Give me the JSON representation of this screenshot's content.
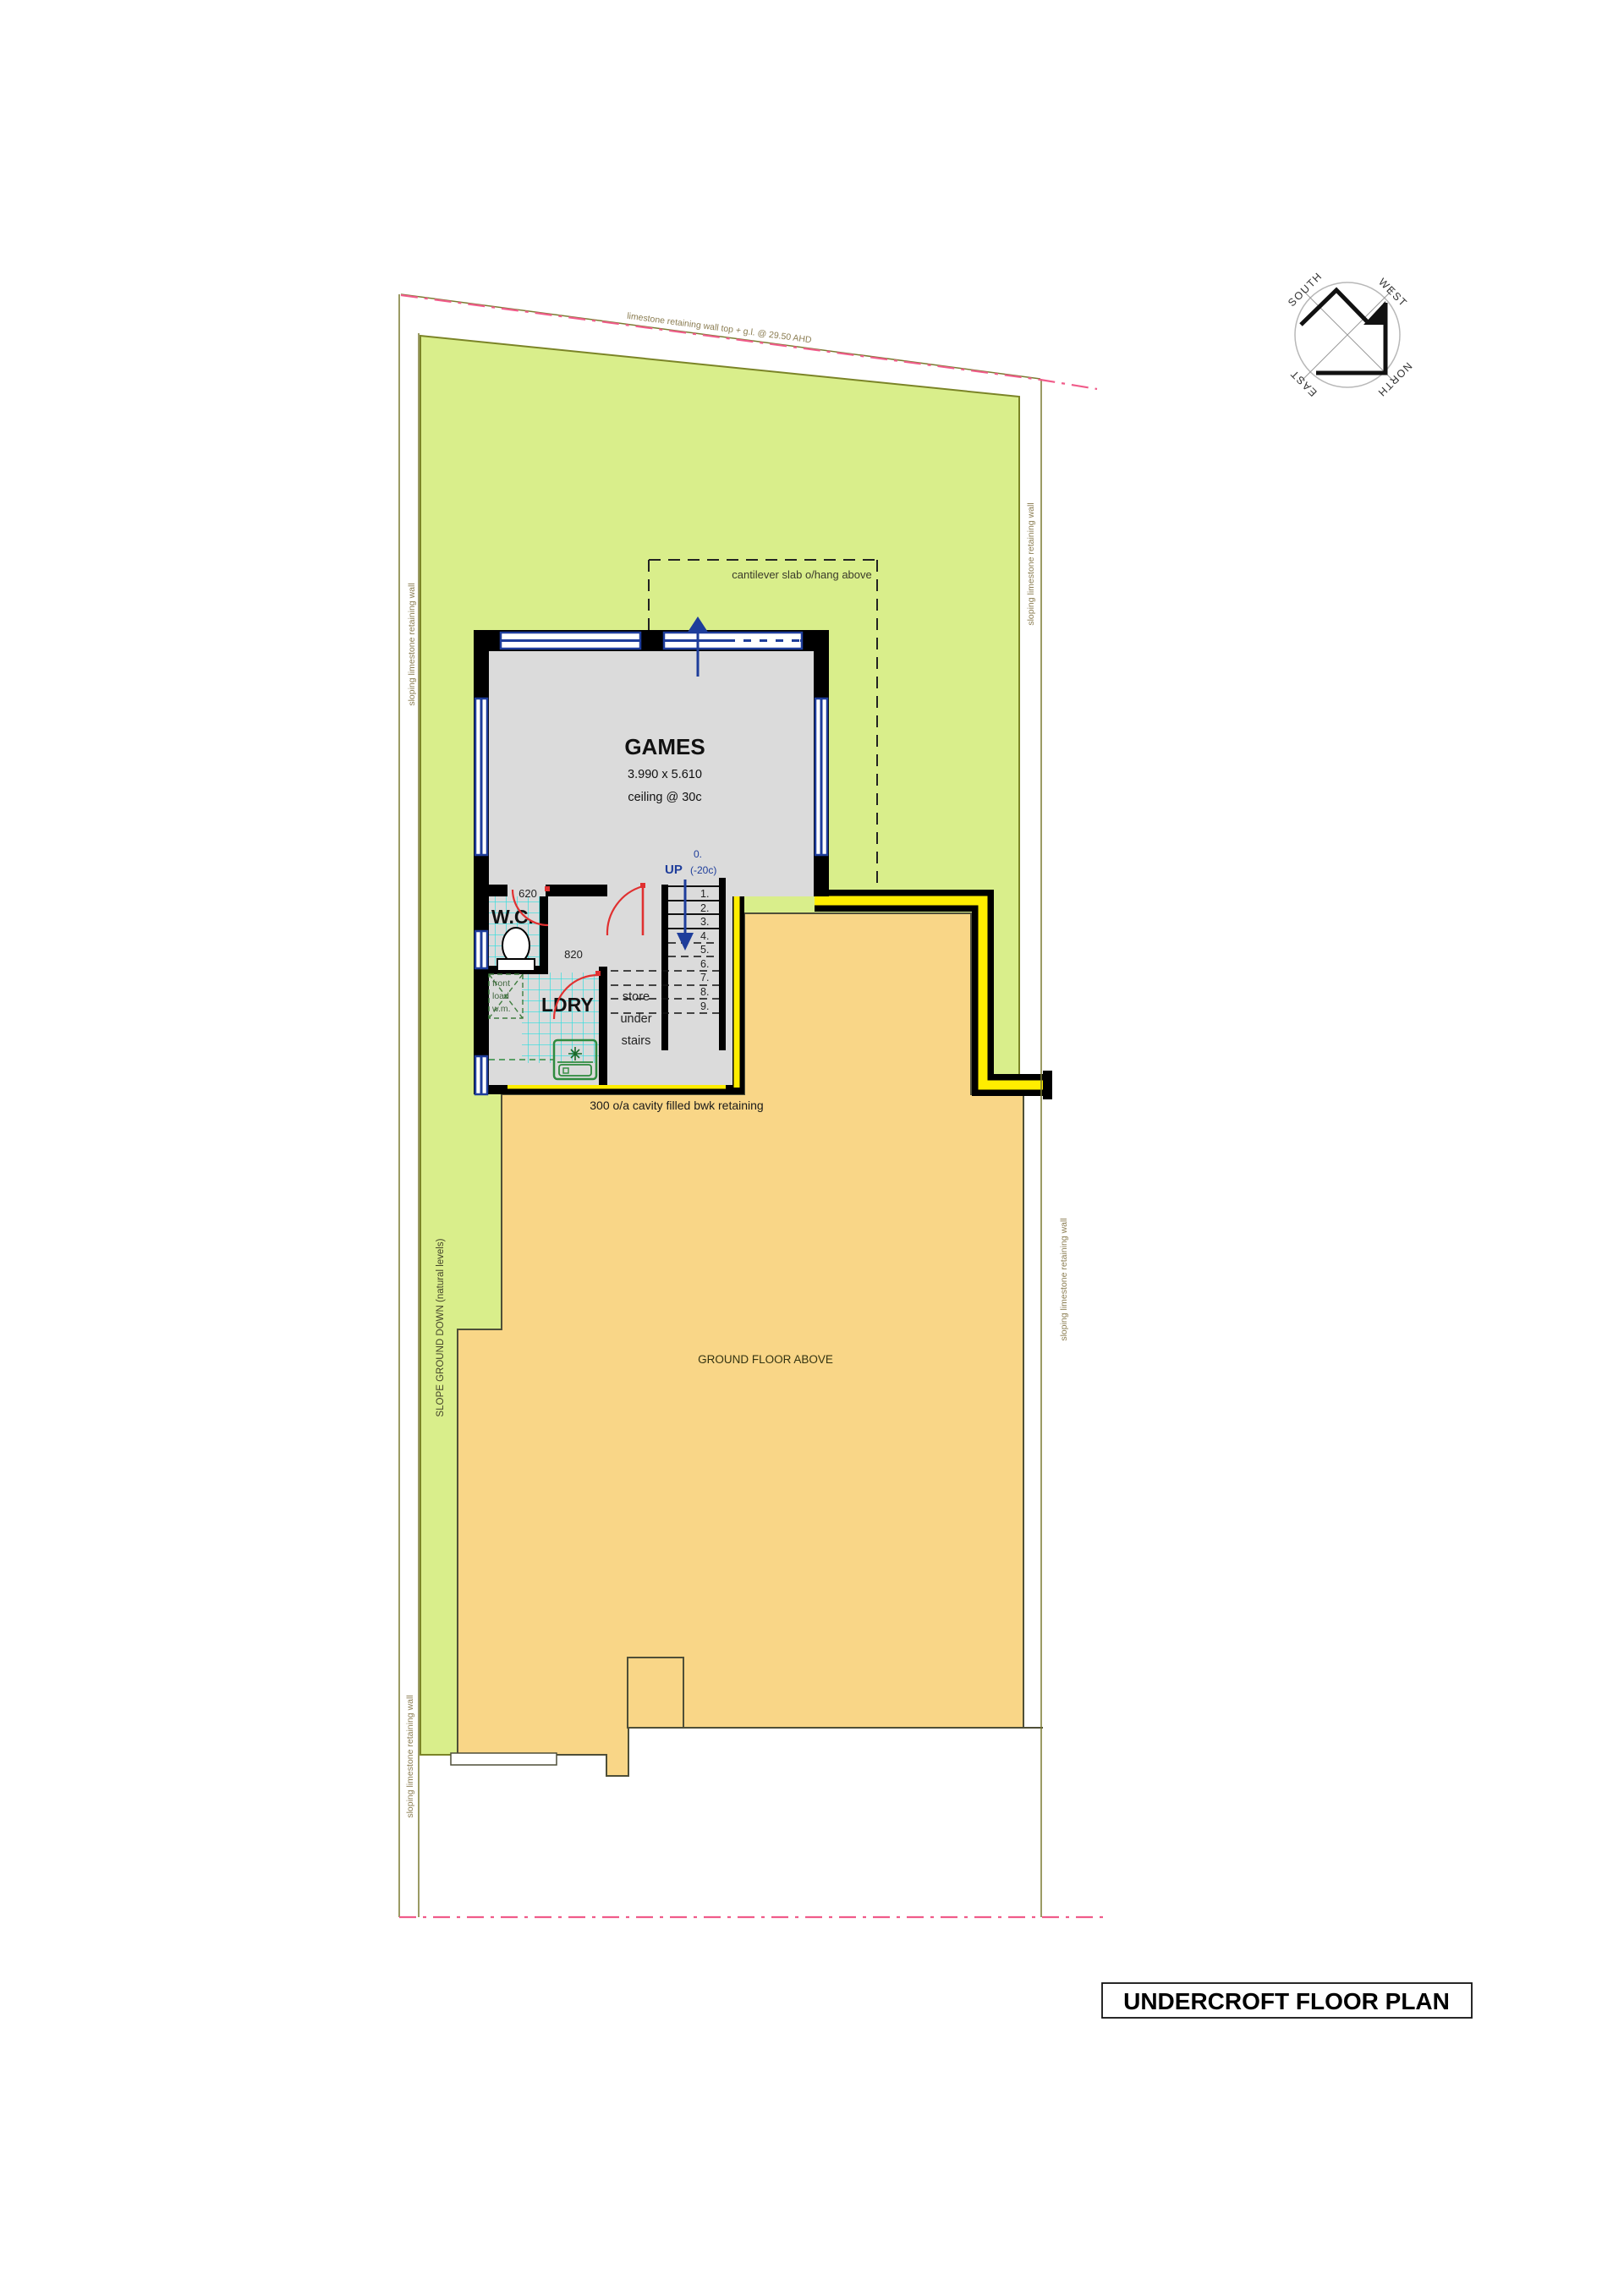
{
  "drawing_title": "UNDERCROFT FLOOR PLAN",
  "boundary": {
    "top_label": "limestone retaining wall top + g.l. @ 29.50 AHD",
    "left_label_upper": "sloping limestone retaining wall",
    "left_label_lower": "sloping limestone retaining wall",
    "right_label_upper": "sloping limestone retaining wall",
    "right_label_lower": "sloping limestone retaining wall"
  },
  "site": {
    "slope_note": "SLOPE GROUND DOWN (natural levels)",
    "ground_floor_note": "GROUND FLOOR ABOVE",
    "retaining_note": "300 o/a cavity filled bwk retaining",
    "cantilever_note": "cantilever slab o/hang above"
  },
  "compass": {
    "south": "SOUTH",
    "west": "WEST",
    "east": "EAST",
    "north": "NORTH"
  },
  "rooms": {
    "games": {
      "name": "GAMES",
      "dims": "3.990 x 5.610",
      "ceiling": "ceiling @ 30c"
    },
    "wc": {
      "name": "W.C.",
      "door_width": "620"
    },
    "ldry": {
      "name": "LDRY",
      "door_width": "820"
    },
    "hall": {
      "door_width": "820"
    },
    "wm": {
      "line1": "front",
      "line2": "load",
      "line3": "w.m."
    },
    "store": {
      "line1": "store",
      "line2": "under",
      "line3": "stairs"
    }
  },
  "stairs": {
    "up_label": "UP",
    "start_label": "0.",
    "level_label": "(-20c)",
    "treads": [
      "1.",
      "2.",
      "3.",
      "4.",
      "5.",
      "6.",
      "7.",
      "8.",
      "9."
    ]
  },
  "colors": {
    "site_green": "#d9ee8b",
    "site_green_border": "#7b8427",
    "ground_floor_orange": "#f9d687",
    "orange_outline": "#4f4f38",
    "retaining_yellow": "#ffed00",
    "wall_black": "#000000",
    "room_grey": "#dbdbdb",
    "window_navy": "#1e3d9b",
    "tile_cyan": "#2adede",
    "door_red": "#e03030",
    "boundary_pink": "#f05c8a",
    "boundary_olive": "#7a7a30",
    "label_olive": "#8b7d52",
    "fixture_green": "#2e8b3e"
  }
}
